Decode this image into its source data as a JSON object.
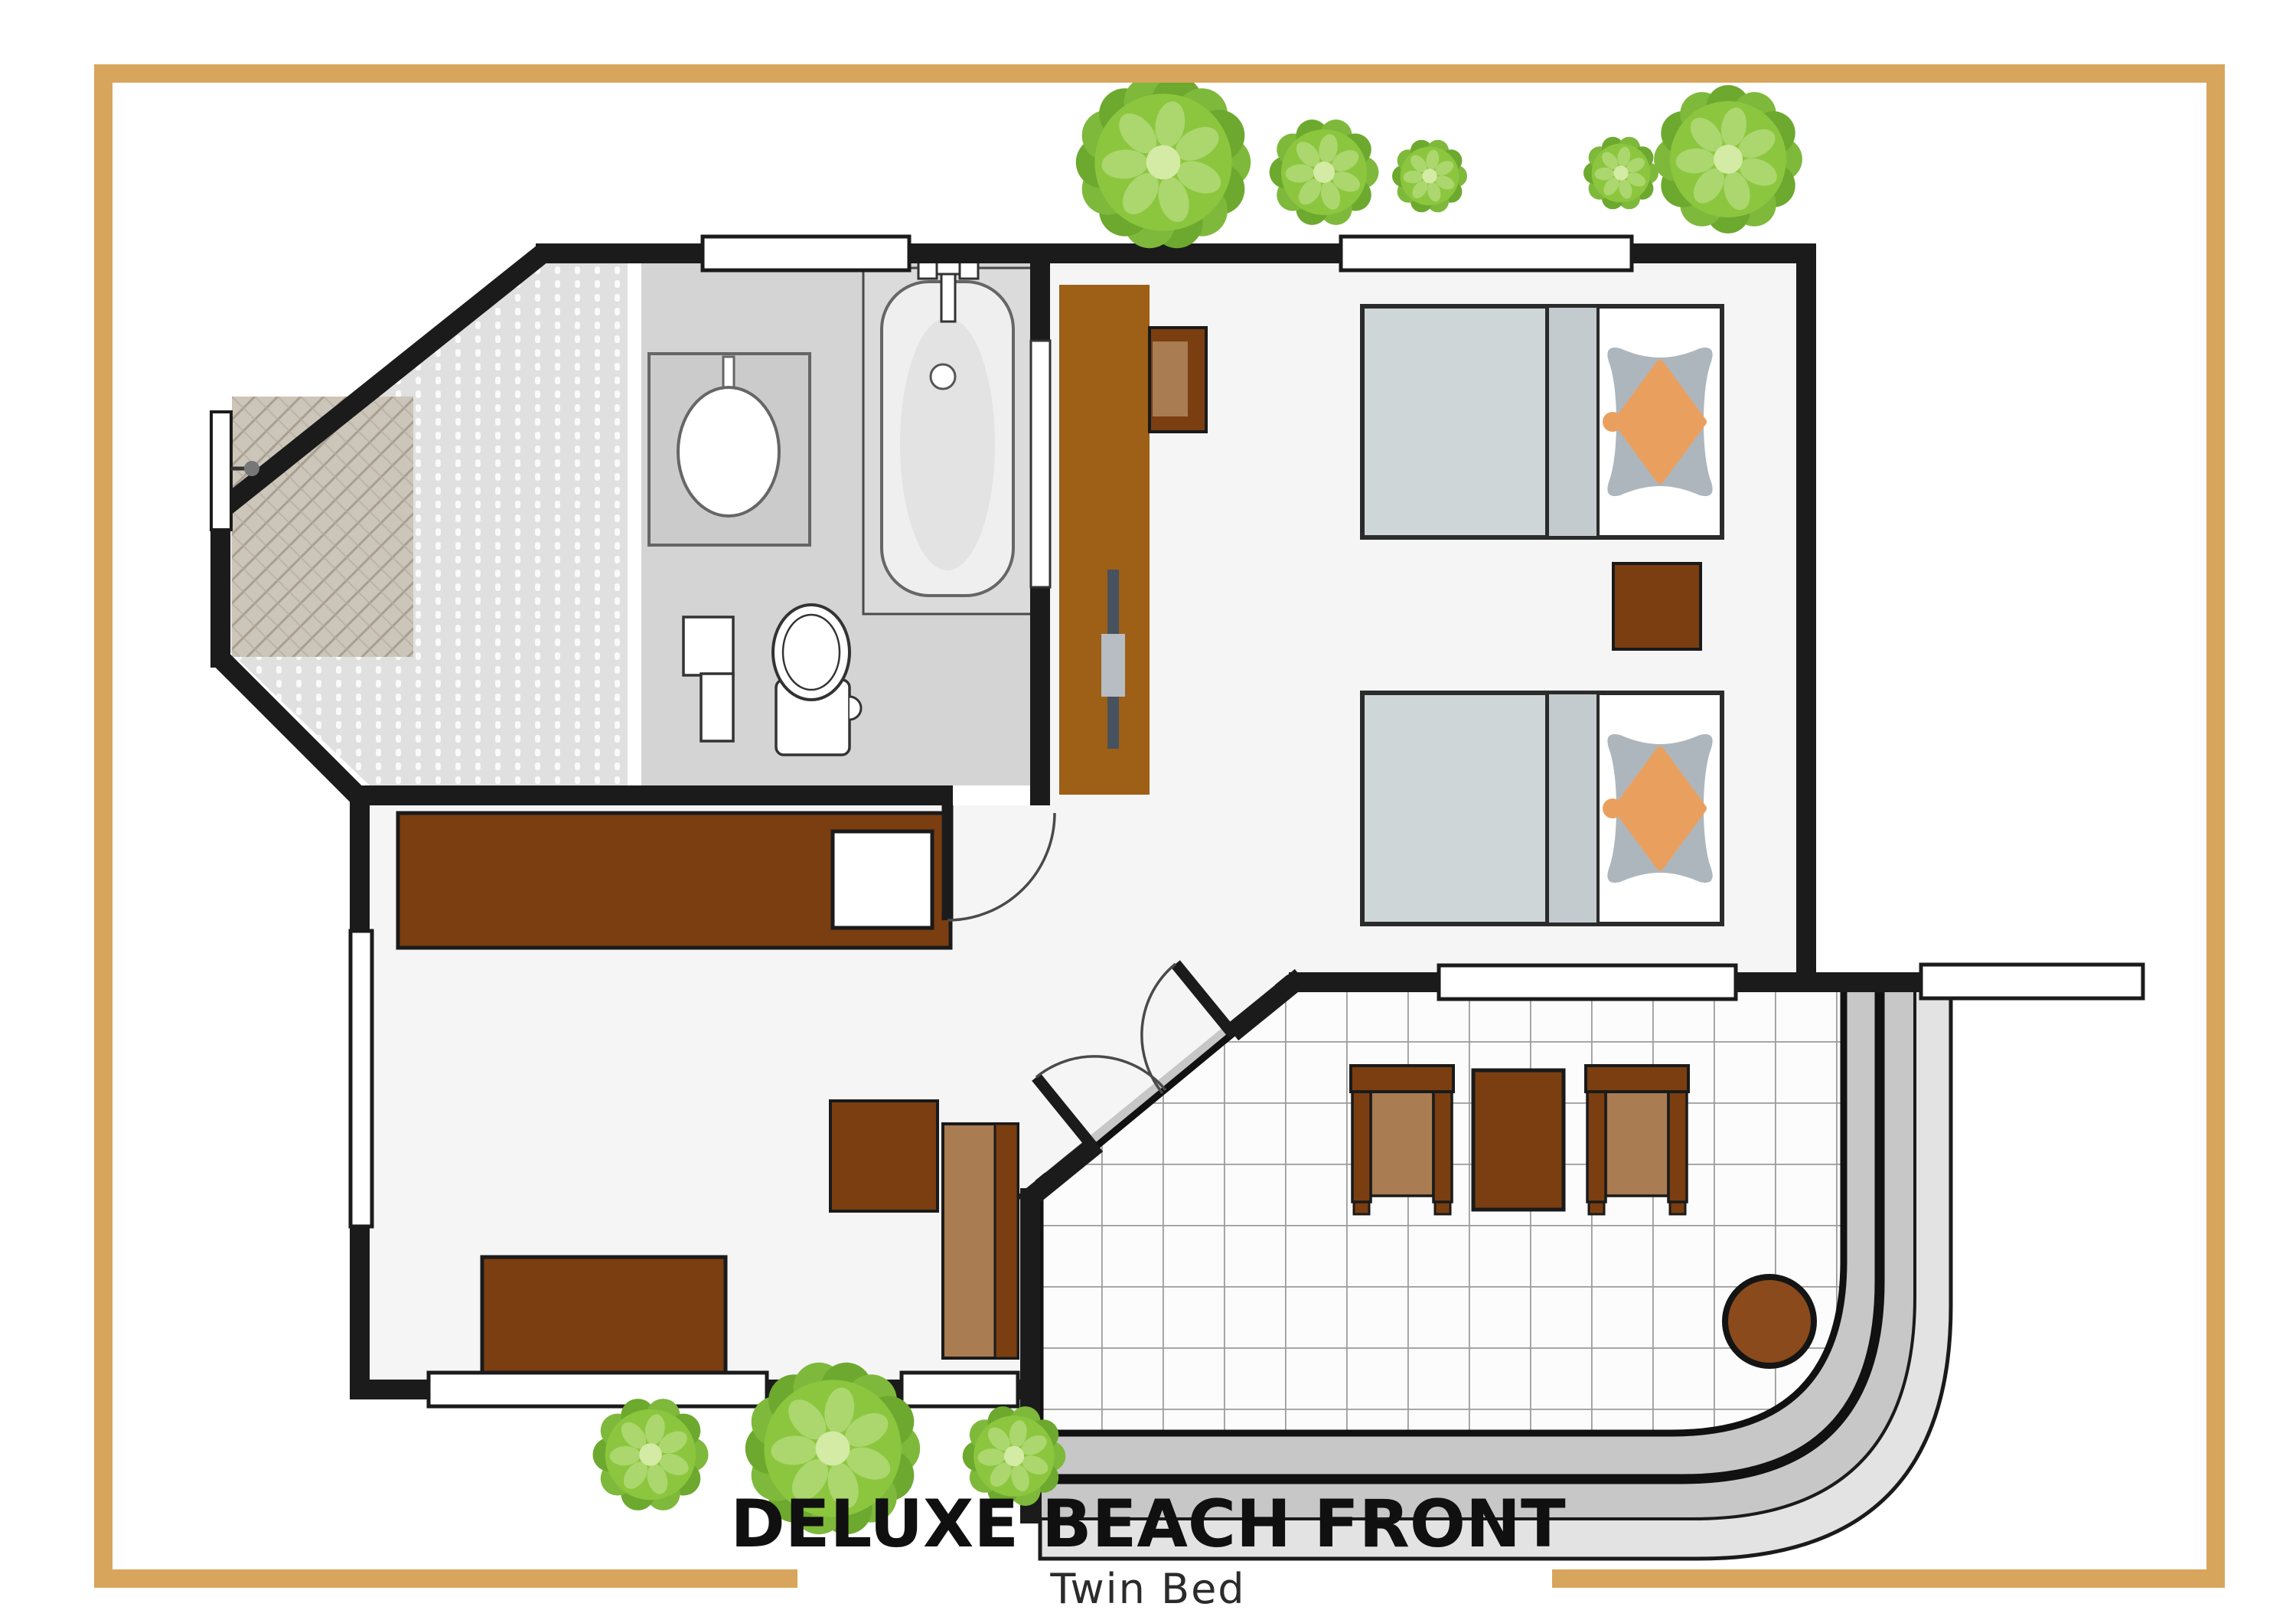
{
  "title": {
    "main": "DELUXE BEACH FRONT",
    "subtitle": "Twin Bed"
  },
  "frame": {
    "color": "#D8A55C"
  },
  "colors": {
    "wall": "#1B1B1B",
    "wood_dark": "#7A3E10",
    "wood_wardrobe": "#9E5F16",
    "wood_seat_light": "#A97C52",
    "stool_brown": "#8A4A1B",
    "floor_interior": "#F5F5F6",
    "floor_bathroom": "#D4D4D4",
    "floor_vestibule": "#E0E0E0",
    "entry_mat": "#CCC5BA",
    "duvet_gray": "#CFD6D8",
    "pillow_gray": "#AEB6BD",
    "pillow_accent_orange": "#E9A05F",
    "terrace_band_gray": "#C7C7C7",
    "terrace_band_light": "#E3E3E3",
    "tile_line": "#9B9B9B",
    "leaf_dark": "#6CA92E",
    "leaf_mid": "#8CC63F",
    "leaf_light": "#ABD76E",
    "leaf_highlight": "#D3EBA4"
  },
  "legend": {
    "rooms": [
      "entry-vestibule",
      "bathroom",
      "twin-bedroom",
      "living-area",
      "terrace"
    ],
    "furniture": [
      "entry-door",
      "doormat",
      "sink-counter",
      "bathtub",
      "toilet",
      "bath-cabinet",
      "sliding-door",
      "wardrobe",
      "desk-chair",
      "twin-bed-1",
      "twin-bed-2",
      "nightstand",
      "tv-console",
      "coffee-table",
      "lounge-chair",
      "side-table",
      "french-doors",
      "terrace-armchair-left",
      "terrace-table",
      "terrace-armchair-right",
      "round-side-table"
    ],
    "vegetation": "tree-icons (5 top, 3 bottom)"
  }
}
